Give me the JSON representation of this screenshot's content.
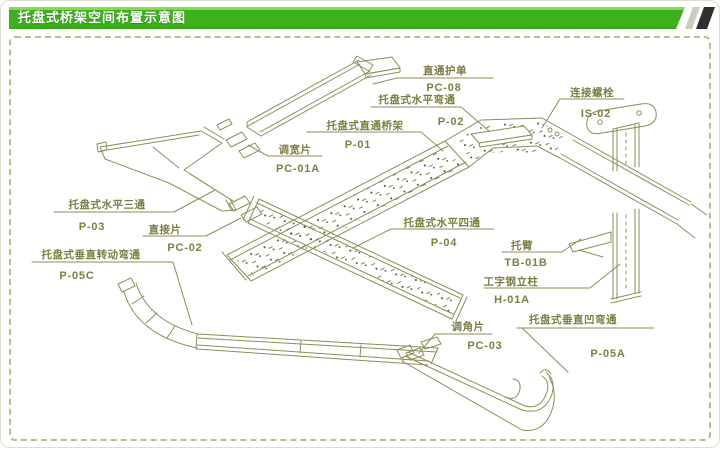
{
  "header": {
    "title": "托盘式桥架空间布置示意图"
  },
  "colors": {
    "header_green": "#3cb11c",
    "header_green_light": "#86d957",
    "line_olive": "#8d8e58",
    "label_text": "#7d7e44",
    "dash_border": "#b9bc8c",
    "deco_dark_slash": "#2f3029",
    "deco_light_slash": "#c9cdbc"
  },
  "parts": [
    {
      "name": "直通护单",
      "code": "PC-08"
    },
    {
      "name": "托盘式水平弯通",
      "code": "P-02"
    },
    {
      "name": "托盘式直通桥架",
      "code": "P-01"
    },
    {
      "name": "连接螺栓",
      "code": "IS-02"
    },
    {
      "name": "调宽片",
      "code": "PC-01A"
    },
    {
      "name": "托盘式水平三通",
      "code": "P-03"
    },
    {
      "name": "直接片",
      "code": "PC-02"
    },
    {
      "name": "托盘式垂直转动弯通",
      "code": "P-05C"
    },
    {
      "name": "托盘式水平四通",
      "code": "P-04"
    },
    {
      "name": "托臂",
      "code": "TB-01B"
    },
    {
      "name": "工字钢立柱",
      "code": "H-01A"
    },
    {
      "name": "调角片",
      "code": "PC-03"
    },
    {
      "name": "托盘式垂直凹弯通",
      "code": "P-05A"
    }
  ]
}
